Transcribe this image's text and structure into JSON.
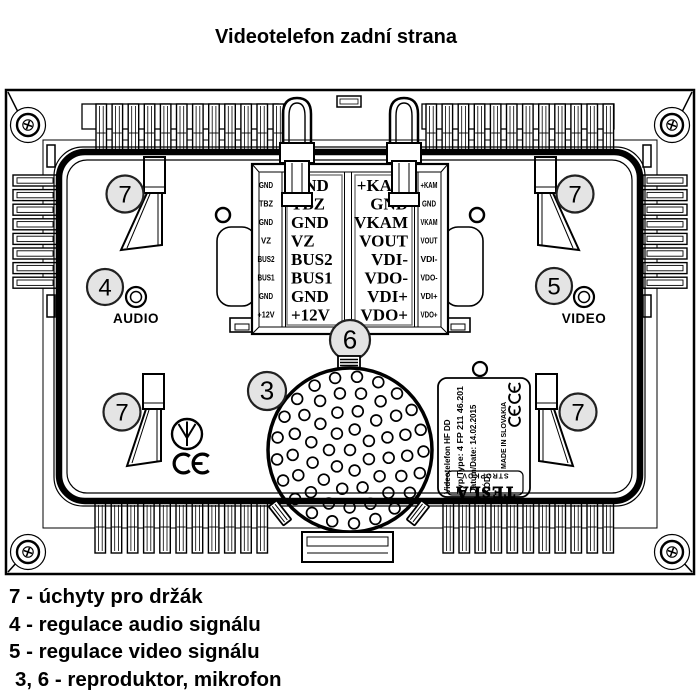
{
  "title": "Videotelefon zadní strana",
  "diagram": {
    "terminal": {
      "left": [
        "GND",
        "TBZ",
        "GND",
        "VZ",
        "BUS2",
        "BUS1",
        "GND",
        "+12V"
      ],
      "right": [
        "+KAM",
        "GND",
        "VKAM",
        "VOUT",
        "VDI-",
        "VDO-",
        "VDI+",
        "VDO+"
      ]
    },
    "callouts": {
      "c3": "3",
      "c4": "4",
      "c5": "5",
      "c6": "6",
      "c7": "7"
    },
    "audio_label": "AUDIO",
    "video_label": "VIDEO",
    "sticker": {
      "line1": "Videotelefon HF DD",
      "line2": "Typ/Type: 4 FP 211 46.201",
      "line3": "Datum/Date: 14.02.2015",
      "line4": "KÓD:",
      "made_in": "MADE IN SLOVAKIA",
      "brand": "TESLA",
      "city": "STROPKOV"
    },
    "colors": {
      "ink": "#000000",
      "paper": "#ffffff",
      "callout_fill": "#e4e4e4"
    }
  },
  "legend": [
    "7 - úchyty pro držák",
    "4 - regulace audio signálu",
    "5 - regulace video signálu",
    "3, 6 - reproduktor, mikrofon"
  ]
}
